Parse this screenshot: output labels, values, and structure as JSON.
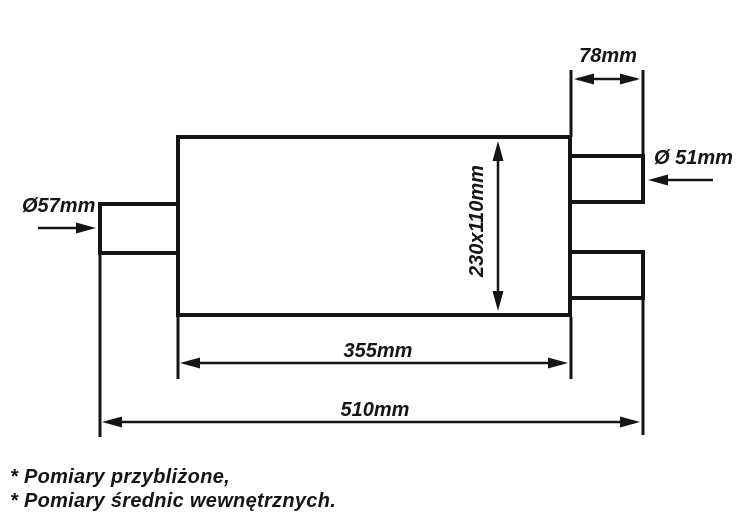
{
  "drawing": {
    "title_hint": "muffler-technical-drawing",
    "dimensions": {
      "inlet_diameter": "Ø57mm",
      "outlet_diameter": "Ø 51mm",
      "outlet_pipe_length": "78mm",
      "body_cross_section": "230x110mm",
      "body_length": "355mm",
      "total_length": "510mm"
    },
    "footnotes": [
      "* Pomiary przybliżone,",
      "* Pomiary średnic wewnętrznych."
    ],
    "colors": {
      "line": "#151515",
      "background": "#ffffff"
    }
  }
}
